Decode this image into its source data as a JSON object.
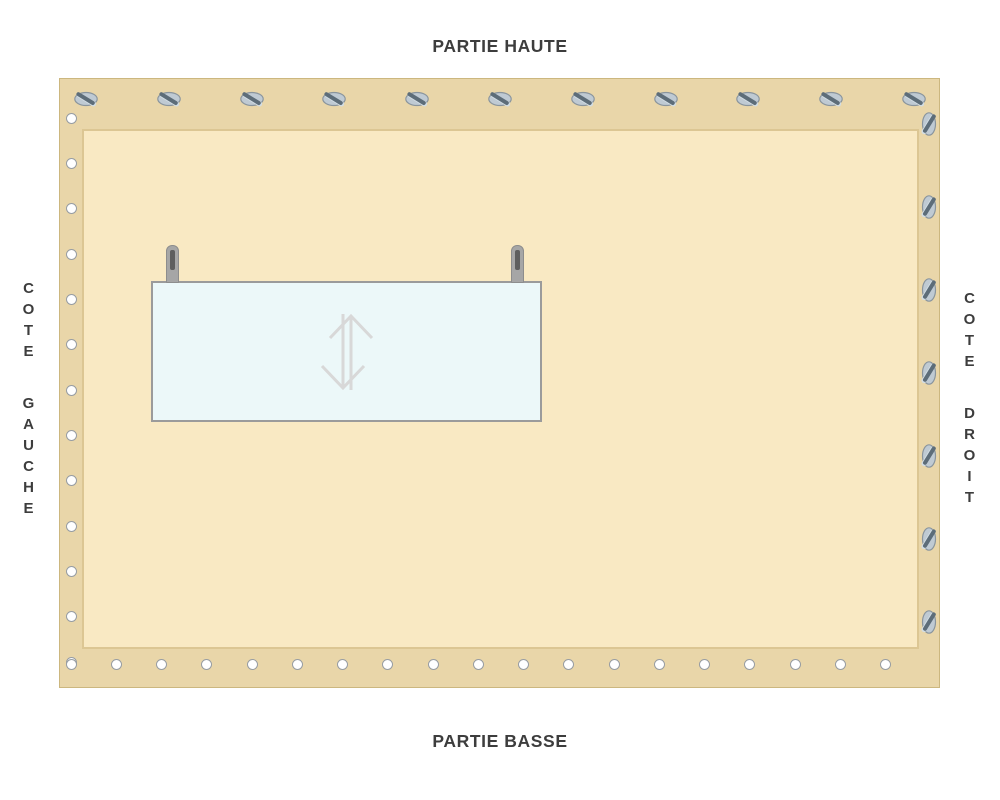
{
  "title_labels": {
    "top": "PARTIE HAUTE",
    "bottom": "PARTIE BASSE",
    "left": "COTE GAUCHE",
    "right": "COTE DROIT"
  },
  "tarp": {
    "fasteners": {
      "top_screws_count": 11,
      "right_screws_count": 7,
      "left_eyelets_count": 13,
      "bottom_eyelets_count": 19
    },
    "window": {
      "pins_count": 2,
      "icon": "resize-vertical-icon"
    }
  },
  "colors": {
    "background": "#ffffff",
    "tarp_band": "#e9d6a9",
    "tarp_border": "#ccb77f",
    "tarp_inner": "#f9e9c3",
    "inner_border": "#dcc693",
    "screw_fill": "#bfcad3",
    "screw_stroke": "#8a959d",
    "screw_slot": "#5d6d79",
    "screw_slot_highlight": "#d2dde4",
    "eyelet_fill": "#ffffff",
    "eyelet_stroke": "#979da3",
    "window_fill": "#ecf8f9",
    "window_border": "#9b9b9b",
    "pin_body": "#a6a6a6",
    "pin_core": "#5e5e5e",
    "arrow": "#d8d8d8",
    "label_text": "#3d3d3d"
  }
}
